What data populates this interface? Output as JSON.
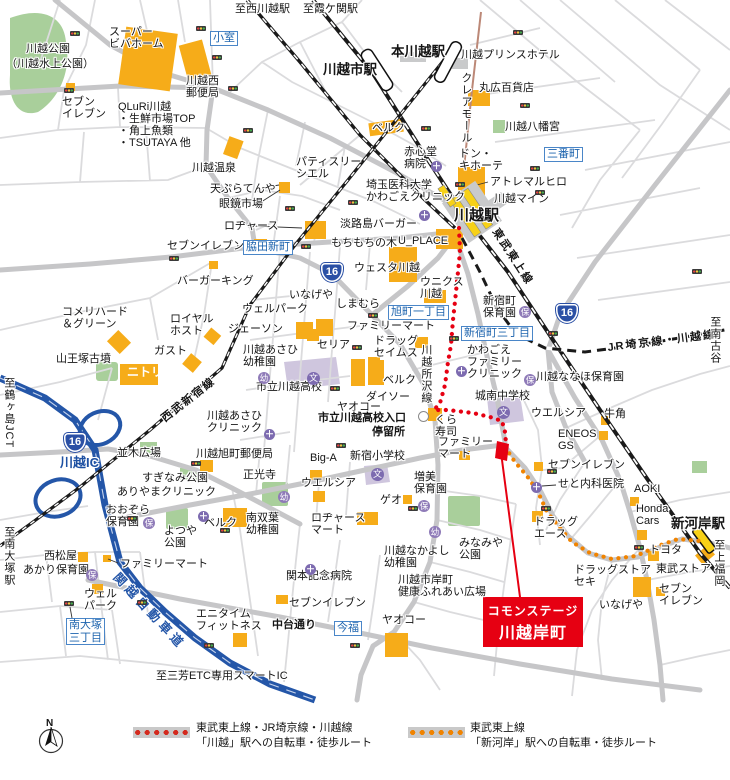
{
  "site": {
    "line1": "コモンステージ",
    "line2": "川越岸町"
  },
  "legend": {
    "compass": "N",
    "items": [
      {
        "swatch": "red-dotted-route",
        "text": "東武東上線・JR埼京線・川越線\n「川越」駅への自転車・徒歩ルート"
      },
      {
        "swatch": "orange-dotted-route",
        "text": "東武東上線\n「新河岸」駅への自転車・徒歩ルート"
      }
    ]
  },
  "colors": {
    "route_kawagoe": "#E60012",
    "route_shingashi": "#F08300",
    "expressway": "#2456A8",
    "building": "#F6AC19",
    "park": "#A9CF9B",
    "school_area": "#CFC6DE",
    "accent_blue_box": "#1E64AE"
  },
  "route_shield_label": "16",
  "route_shields": [
    {
      "x": 321,
      "y": 263
    },
    {
      "x": 64,
      "y": 433
    },
    {
      "x": 556,
      "y": 304
    }
  ],
  "icon_glyphs": {
    "clinic": "＋",
    "school": "文"
  },
  "icons": {
    "signals": [
      [
        70,
        31
      ],
      [
        196,
        26
      ],
      [
        212,
        55
      ],
      [
        64,
        88
      ],
      [
        228,
        86
      ],
      [
        243,
        128
      ],
      [
        421,
        126
      ],
      [
        455,
        182
      ],
      [
        513,
        30
      ],
      [
        520,
        103
      ],
      [
        530,
        166
      ],
      [
        535,
        190
      ],
      [
        348,
        200
      ],
      [
        285,
        206
      ],
      [
        301,
        244
      ],
      [
        169,
        256
      ],
      [
        368,
        313
      ],
      [
        352,
        345
      ],
      [
        449,
        336
      ],
      [
        330,
        386
      ],
      [
        336,
        443
      ],
      [
        191,
        461
      ],
      [
        127,
        516
      ],
      [
        220,
        528
      ],
      [
        137,
        600
      ],
      [
        64,
        601
      ],
      [
        204,
        643
      ],
      [
        350,
        643
      ],
      [
        408,
        506
      ],
      [
        541,
        506
      ],
      [
        634,
        545
      ],
      [
        547,
        469
      ],
      [
        548,
        331
      ],
      [
        692,
        269
      ]
    ],
    "clinics": [
      [
        431,
        161
      ],
      [
        419,
        210
      ],
      [
        456,
        366
      ],
      [
        264,
        429
      ],
      [
        198,
        511
      ],
      [
        531,
        482
      ],
      [
        305,
        564
      ]
    ],
    "schools": [
      [
        307,
        372
      ],
      [
        497,
        406
      ],
      [
        371,
        468
      ]
    ],
    "nurseries": [
      {
        "x": 258,
        "y": 372,
        "k": "幼"
      },
      {
        "x": 278,
        "y": 491,
        "k": "幼"
      },
      {
        "x": 429,
        "y": 526,
        "k": "幼"
      },
      {
        "x": 86,
        "y": 569,
        "k": "保"
      },
      {
        "x": 143,
        "y": 517,
        "k": "保"
      },
      {
        "x": 418,
        "y": 500,
        "k": "保"
      },
      {
        "x": 519,
        "y": 306,
        "k": "保"
      },
      {
        "x": 524,
        "y": 374,
        "k": "保"
      }
    ],
    "busstops": [
      [
        418,
        411
      ]
    ]
  },
  "labels": [
    {
      "t": "至西川越駅",
      "x": 235,
      "y": 4
    },
    {
      "t": "至霞ケ関駅",
      "x": 303,
      "y": 4
    },
    {
      "t": "スーパー\nビバホーム",
      "x": 109,
      "y": 27
    },
    {
      "t": "川越公園",
      "x": 26,
      "y": 44
    },
    {
      "t": "（川越水上公園）",
      "x": 6,
      "y": 59
    },
    {
      "t": "小室",
      "x": 210,
      "y": 31,
      "c": "box"
    },
    {
      "t": "本川越駅",
      "x": 391,
      "y": 45,
      "c": "st"
    },
    {
      "t": "川越市駅",
      "x": 323,
      "y": 63,
      "c": "st"
    },
    {
      "t": "川越プリンスホテル",
      "x": 461,
      "y": 50
    },
    {
      "t": "川越西\n郵便局",
      "x": 186,
      "y": 76
    },
    {
      "t": "セブン\nイレブン",
      "x": 62,
      "y": 97
    },
    {
      "t": "QLuRi川越\n・生鮮市場TOP\n・角上魚類\n・TSUTAYA 他",
      "x": 118,
      "y": 102
    },
    {
      "t": "クレアモール",
      "x": 459,
      "y": 72,
      "c": "vert"
    },
    {
      "t": "丸広百貨店",
      "x": 479,
      "y": 83
    },
    {
      "t": "川越八幡宮",
      "x": 505,
      "y": 122
    },
    {
      "t": "三番町",
      "x": 544,
      "y": 147,
      "c": "box"
    },
    {
      "t": "ベルク",
      "x": 372,
      "y": 123
    },
    {
      "t": "赤心堂\n病院",
      "x": 404,
      "y": 147
    },
    {
      "t": "ドン・\nキホーテ",
      "x": 459,
      "y": 149
    },
    {
      "t": "アトレマルヒロ",
      "x": 490,
      "y": 177
    },
    {
      "t": "川越マイン",
      "x": 494,
      "y": 194
    },
    {
      "t": "埼玉医科大学\nかわごえクリニック",
      "x": 366,
      "y": 180
    },
    {
      "t": "川越駅",
      "x": 454,
      "y": 208,
      "c": "st15"
    },
    {
      "t": "川越温泉",
      "x": 192,
      "y": 163
    },
    {
      "t": "天ぷらてんや",
      "x": 210,
      "y": 184
    },
    {
      "t": "眼鏡市場",
      "x": 219,
      "y": 199
    },
    {
      "t": "パティスリー\nシエル",
      "x": 296,
      "y": 157
    },
    {
      "t": "ロヂャース",
      "x": 224,
      "y": 221
    },
    {
      "t": "淡路島バーガー",
      "x": 340,
      "y": 219
    },
    {
      "t": "もちもちの木",
      "x": 331,
      "y": 238
    },
    {
      "t": "U_PLACE",
      "x": 398,
      "y": 236
    },
    {
      "t": "セブンイレブン",
      "x": 167,
      "y": 241
    },
    {
      "t": "脇田新町",
      "x": 243,
      "y": 240,
      "c": "box"
    },
    {
      "t": "東武東上線",
      "x": 499,
      "y": 227,
      "c": "rail",
      "r": 57
    },
    {
      "t": "ウェスタ川越",
      "x": 354,
      "y": 263
    },
    {
      "t": "ウニクス\n川越",
      "x": 420,
      "y": 277
    },
    {
      "t": "バーガーキング",
      "x": 177,
      "y": 276
    },
    {
      "t": "いなげや",
      "x": 289,
      "y": 290
    },
    {
      "t": "しまむら",
      "x": 336,
      "y": 299
    },
    {
      "t": "新宿町\n保育園",
      "x": 483,
      "y": 296
    },
    {
      "t": "旭町一丁目",
      "x": 388,
      "y": 305,
      "c": "box"
    },
    {
      "t": "コメリハード\n＆グリーン",
      "x": 62,
      "y": 307
    },
    {
      "t": "ロイヤル\nホスト",
      "x": 170,
      "y": 314
    },
    {
      "t": "ウェルパーク",
      "x": 242,
      "y": 304
    },
    {
      "t": "ジェーソン",
      "x": 228,
      "y": 324
    },
    {
      "t": "新宿町三丁目",
      "x": 461,
      "y": 326,
      "c": "box"
    },
    {
      "t": "JR埼京線・川越線",
      "x": 607,
      "y": 343,
      "c": "rail",
      "r": -7
    },
    {
      "t": "至南古谷",
      "x": 708,
      "y": 316,
      "c": "vert"
    },
    {
      "t": "山王塚古墳",
      "x": 56,
      "y": 354
    },
    {
      "t": "ガスト",
      "x": 154,
      "y": 346
    },
    {
      "t": "ニトリ",
      "x": 127,
      "y": 366,
      "c": "wt"
    },
    {
      "t": "ファミリーマート",
      "x": 347,
      "y": 321
    },
    {
      "t": "ドラッグ\nセイムス",
      "x": 374,
      "y": 336
    },
    {
      "t": "セリア",
      "x": 317,
      "y": 340
    },
    {
      "t": "川越あさひ\n幼稚園",
      "x": 243,
      "y": 345
    },
    {
      "t": "かわごえ\nファミリー\nクリニック",
      "x": 467,
      "y": 345
    },
    {
      "t": "川越ななほ保育園",
      "x": 536,
      "y": 372
    },
    {
      "t": "西武新宿線",
      "x": 160,
      "y": 416,
      "c": "rail",
      "r": -38
    },
    {
      "t": "ベルク",
      "x": 383,
      "y": 375
    },
    {
      "t": "川越所沢線",
      "x": 419,
      "y": 344,
      "c": "vert"
    },
    {
      "t": "市立川越高校",
      "x": 256,
      "y": 382
    },
    {
      "t": "ダイソー",
      "x": 366,
      "y": 392
    },
    {
      "t": "城南中学校",
      "x": 475,
      "y": 391
    },
    {
      "t": "ヤオコー",
      "x": 337,
      "y": 402
    },
    {
      "t": "ウエルシア",
      "x": 531,
      "y": 408
    },
    {
      "t": "牛角",
      "x": 604,
      "y": 409
    },
    {
      "t": "市立川越高校入口",
      "x": 318,
      "y": 413,
      "c": "b"
    },
    {
      "t": "停留所",
      "x": 372,
      "y": 427,
      "c": "b"
    },
    {
      "t": "くら\n寿司",
      "x": 435,
      "y": 415
    },
    {
      "t": "ENEOS\nGS",
      "x": 558,
      "y": 429
    },
    {
      "t": "川越あさひ\nクリニック",
      "x": 207,
      "y": 411
    },
    {
      "t": "川越旭町郵便局",
      "x": 196,
      "y": 449
    },
    {
      "t": "並木広場",
      "x": 117,
      "y": 448
    },
    {
      "t": "川越IC",
      "x": 60,
      "y": 456,
      "c": "ic"
    },
    {
      "t": "至鶴ヶ島JCT",
      "x": 2,
      "y": 377,
      "c": "vert"
    },
    {
      "t": "Big-A",
      "x": 310,
      "y": 453
    },
    {
      "t": "新宿小学校",
      "x": 350,
      "y": 451
    },
    {
      "t": "ファミリー\nマート",
      "x": 438,
      "y": 437
    },
    {
      "t": "正光寺",
      "x": 243,
      "y": 470
    },
    {
      "t": "すぎなみ公園",
      "x": 142,
      "y": 473
    },
    {
      "t": "ありやまクリニック",
      "x": 117,
      "y": 487
    },
    {
      "t": "ウエルシア",
      "x": 301,
      "y": 478
    },
    {
      "t": "増美\n保育園",
      "x": 414,
      "y": 472
    },
    {
      "t": "ゲオ",
      "x": 380,
      "y": 495
    },
    {
      "t": "セブンイレブン",
      "x": 548,
      "y": 460
    },
    {
      "t": "せと内科医院",
      "x": 558,
      "y": 479
    },
    {
      "t": "AOKI",
      "x": 634,
      "y": 484
    },
    {
      "t": "おおぞら\n保育園",
      "x": 106,
      "y": 505
    },
    {
      "t": "よつや\n公園",
      "x": 164,
      "y": 526
    },
    {
      "t": "ベルク",
      "x": 204,
      "y": 518
    },
    {
      "t": "西松屋",
      "x": 44,
      "y": 551
    },
    {
      "t": "あかり保育園",
      "x": 23,
      "y": 565
    },
    {
      "t": "ファミリーマート",
      "x": 120,
      "y": 559
    },
    {
      "t": "ウェル\nパーク",
      "x": 84,
      "y": 589
    },
    {
      "t": "南大塚\n三丁目",
      "x": 66,
      "y": 618,
      "c": "box"
    },
    {
      "t": "至南大塚駅",
      "x": 2,
      "y": 526,
      "c": "vert"
    },
    {
      "t": "関越自動車道",
      "x": 120,
      "y": 571,
      "c": "exp",
      "r": 47
    },
    {
      "t": "エニタイム\nフィットネス",
      "x": 196,
      "y": 609
    },
    {
      "t": "至三芳ETC専用スマートIC",
      "x": 156,
      "y": 671
    },
    {
      "t": "南双葉\n幼稚園",
      "x": 246,
      "y": 513
    },
    {
      "t": "ロヂャース\nマート",
      "x": 311,
      "y": 513
    },
    {
      "t": "関本記念病院",
      "x": 286,
      "y": 571
    },
    {
      "t": "セブンイレブン",
      "x": 289,
      "y": 598
    },
    {
      "t": "中台通り",
      "x": 272,
      "y": 620,
      "c": "b"
    },
    {
      "t": "今福",
      "x": 334,
      "y": 621,
      "c": "box"
    },
    {
      "t": "ヤオコー",
      "x": 382,
      "y": 615
    },
    {
      "t": "川越なかよし\n幼稚園",
      "x": 384,
      "y": 546
    },
    {
      "t": "みなみや\n公園",
      "x": 459,
      "y": 538
    },
    {
      "t": "川越市岸町\n健康ふれあい広場",
      "x": 398,
      "y": 575
    },
    {
      "t": "ドラッグ\nエース",
      "x": 534,
      "y": 517
    },
    {
      "t": "ドラッグストア\nセキ",
      "x": 574,
      "y": 565
    },
    {
      "t": "いなげや",
      "x": 599,
      "y": 600
    },
    {
      "t": "セブン\nイレブン",
      "x": 659,
      "y": 584
    },
    {
      "t": "東武ストア",
      "x": 656,
      "y": 564
    },
    {
      "t": "トヨタ",
      "x": 649,
      "y": 545
    },
    {
      "t": "Honda\nCars",
      "x": 636,
      "y": 504
    },
    {
      "t": "新河岸駅",
      "x": 671,
      "y": 517,
      "c": "st"
    },
    {
      "t": "至上福岡",
      "x": 712,
      "y": 539,
      "c": "vert"
    }
  ]
}
